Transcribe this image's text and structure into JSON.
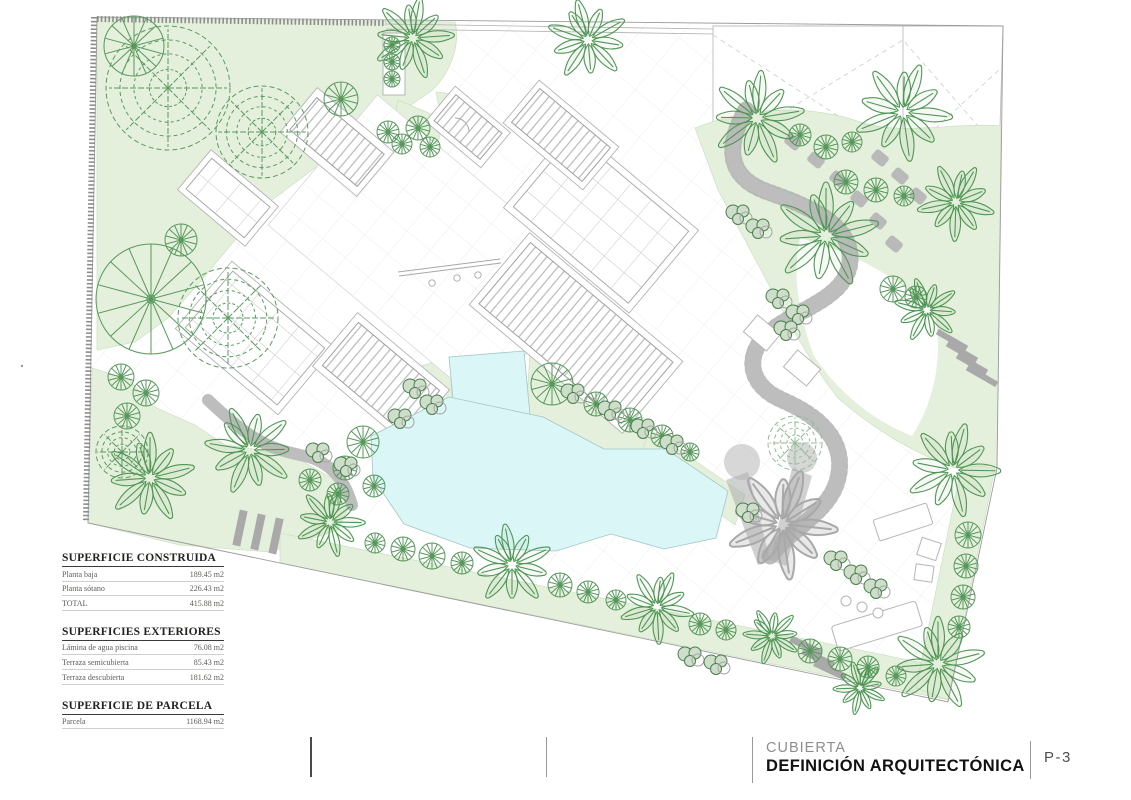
{
  "sheet": {
    "tables": [
      {
        "id": "constructed",
        "title": "SUPERFICIE CONSTRUIDA",
        "rows": [
          {
            "label": "Planta baja",
            "value": "189.45 m2"
          },
          {
            "label": "Planta sótano",
            "value": "226.43 m2"
          },
          {
            "label": "TOTAL",
            "value": "415.88 m2"
          }
        ]
      },
      {
        "id": "exterior",
        "title": "SUPERFICIES EXTERIORES",
        "rows": [
          {
            "label": "Lámina de agua piscina",
            "value": "76.08 m2"
          },
          {
            "label": "Terraza semicubierta",
            "value": "85.43 m2"
          },
          {
            "label": "Terraza descubierta",
            "value": "181.62 m2"
          }
        ]
      },
      {
        "id": "parcel",
        "title": "SUPERFICIE DE PARCELA",
        "rows": [
          {
            "label": "Parcela",
            "value": "1168.94 m2"
          }
        ]
      }
    ],
    "title_block": {
      "phase": "CUBIERTA",
      "title": "DEFINICIÓN ARQUITECTÓNICA",
      "sheet_number": "P-3"
    }
  },
  "plan": {
    "colors": {
      "vegetation_fill": "#e4f0db",
      "tree_stroke": "#4f9654",
      "pool_fill": "#daf6f7",
      "path_gray": "#bdbdbd",
      "wall_gray": "#8d8d8d",
      "roof_line": "#a8a8a8",
      "grid_line": "#ebebeb"
    },
    "vegetation": {
      "palms": [
        {
          "x": 413,
          "y": 38,
          "r": 40,
          "rot": 10
        },
        {
          "x": 588,
          "y": 40,
          "r": 40,
          "rot": -15
        },
        {
          "x": 757,
          "y": 118,
          "r": 46,
          "rot": 5
        },
        {
          "x": 903,
          "y": 112,
          "r": 48,
          "rot": 20
        },
        {
          "x": 826,
          "y": 236,
          "r": 52,
          "rot": 0
        },
        {
          "x": 956,
          "y": 202,
          "r": 38,
          "rot": 30
        },
        {
          "x": 927,
          "y": 310,
          "r": 32,
          "rot": -20
        },
        {
          "x": 953,
          "y": 470,
          "r": 46,
          "rot": 15
        },
        {
          "x": 938,
          "y": 664,
          "r": 46,
          "rot": 0
        },
        {
          "x": 860,
          "y": 688,
          "r": 26,
          "rot": 40
        },
        {
          "x": 512,
          "y": 565,
          "r": 40,
          "rot": -10
        },
        {
          "x": 657,
          "y": 607,
          "r": 36,
          "rot": 25
        },
        {
          "x": 772,
          "y": 636,
          "r": 28,
          "rot": -30
        },
        {
          "x": 150,
          "y": 478,
          "r": 44,
          "rot": 0
        },
        {
          "x": 250,
          "y": 450,
          "r": 44,
          "rot": -25
        },
        {
          "x": 330,
          "y": 522,
          "r": 34,
          "rot": 15
        }
      ],
      "fans": [
        {
          "x": 134,
          "y": 46,
          "r": 30
        },
        {
          "x": 341,
          "y": 99,
          "r": 17
        },
        {
          "x": 388,
          "y": 132,
          "r": 11
        },
        {
          "x": 151,
          "y": 299,
          "r": 55
        },
        {
          "x": 181,
          "y": 240,
          "r": 16
        },
        {
          "x": 121,
          "y": 377,
          "r": 13
        },
        {
          "x": 146,
          "y": 393,
          "r": 13
        },
        {
          "x": 127,
          "y": 416,
          "r": 13
        },
        {
          "x": 418,
          "y": 128,
          "r": 12
        },
        {
          "x": 402,
          "y": 144,
          "r": 10
        },
        {
          "x": 430,
          "y": 147,
          "r": 10
        },
        {
          "x": 552,
          "y": 384,
          "r": 21
        },
        {
          "x": 596,
          "y": 404,
          "r": 12
        },
        {
          "x": 630,
          "y": 420,
          "r": 12
        },
        {
          "x": 662,
          "y": 436,
          "r": 11
        },
        {
          "x": 690,
          "y": 452,
          "r": 9
        },
        {
          "x": 363,
          "y": 442,
          "r": 16
        },
        {
          "x": 345,
          "y": 468,
          "r": 12
        },
        {
          "x": 374,
          "y": 486,
          "r": 11
        },
        {
          "x": 310,
          "y": 480,
          "r": 11
        },
        {
          "x": 338,
          "y": 494,
          "r": 11
        },
        {
          "x": 375,
          "y": 543,
          "r": 10
        },
        {
          "x": 403,
          "y": 549,
          "r": 12
        },
        {
          "x": 432,
          "y": 556,
          "r": 13
        },
        {
          "x": 462,
          "y": 563,
          "r": 11
        },
        {
          "x": 560,
          "y": 585,
          "r": 12
        },
        {
          "x": 588,
          "y": 592,
          "r": 11
        },
        {
          "x": 616,
          "y": 600,
          "r": 10
        },
        {
          "x": 700,
          "y": 624,
          "r": 11
        },
        {
          "x": 726,
          "y": 630,
          "r": 10
        },
        {
          "x": 810,
          "y": 651,
          "r": 12
        },
        {
          "x": 840,
          "y": 659,
          "r": 12
        },
        {
          "x": 868,
          "y": 667,
          "r": 11
        },
        {
          "x": 896,
          "y": 676,
          "r": 10
        },
        {
          "x": 800,
          "y": 135,
          "r": 11
        },
        {
          "x": 826,
          "y": 147,
          "r": 12
        },
        {
          "x": 852,
          "y": 142,
          "r": 10
        },
        {
          "x": 846,
          "y": 182,
          "r": 12
        },
        {
          "x": 876,
          "y": 190,
          "r": 12
        },
        {
          "x": 904,
          "y": 196,
          "r": 10
        },
        {
          "x": 968,
          "y": 535,
          "r": 13
        },
        {
          "x": 966,
          "y": 566,
          "r": 12
        },
        {
          "x": 963,
          "y": 597,
          "r": 12
        },
        {
          "x": 959,
          "y": 627,
          "r": 11
        },
        {
          "x": 893,
          "y": 289,
          "r": 13
        },
        {
          "x": 916,
          "y": 297,
          "r": 11
        },
        {
          "x": 392,
          "y": 45,
          "r": 8
        },
        {
          "x": 392,
          "y": 62,
          "r": 8
        },
        {
          "x": 392,
          "y": 79,
          "r": 8
        }
      ],
      "scribbles": [
        {
          "x": 168,
          "y": 88,
          "r": 62
        },
        {
          "x": 262,
          "y": 132,
          "r": 46
        },
        {
          "x": 228,
          "y": 318,
          "r": 50
        },
        {
          "x": 122,
          "y": 452,
          "r": 26
        },
        {
          "x": 795,
          "y": 443,
          "r": 27,
          "pale": true
        }
      ],
      "shrubs": [
        {
          "x": 415,
          "y": 388
        },
        {
          "x": 432,
          "y": 404
        },
        {
          "x": 400,
          "y": 418
        },
        {
          "x": 573,
          "y": 393
        },
        {
          "x": 610,
          "y": 410
        },
        {
          "x": 643,
          "y": 428
        },
        {
          "x": 672,
          "y": 444
        },
        {
          "x": 748,
          "y": 512
        },
        {
          "x": 318,
          "y": 452
        },
        {
          "x": 346,
          "y": 466
        },
        {
          "x": 778,
          "y": 298
        },
        {
          "x": 798,
          "y": 314
        },
        {
          "x": 786,
          "y": 330
        },
        {
          "x": 836,
          "y": 560
        },
        {
          "x": 856,
          "y": 574
        },
        {
          "x": 876,
          "y": 588
        },
        {
          "x": 738,
          "y": 214
        },
        {
          "x": 758,
          "y": 228
        },
        {
          "x": 690,
          "y": 656
        },
        {
          "x": 716,
          "y": 664
        }
      ]
    }
  }
}
